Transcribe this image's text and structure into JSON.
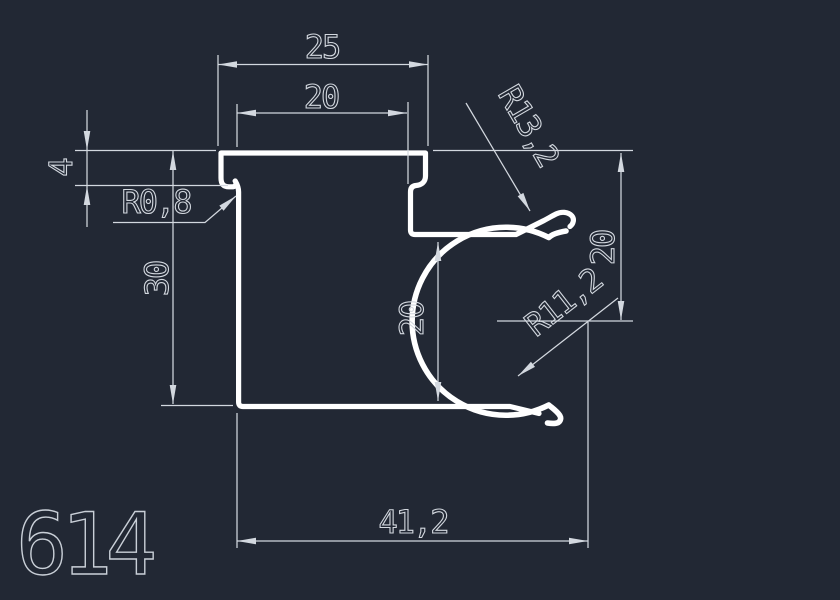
{
  "canvas": {
    "background": "#222834",
    "profile_stroke": "#ffffff",
    "dim_stroke": "#d3d8df",
    "label_color": "#c9cfd7"
  },
  "part": {
    "number": "614"
  },
  "dimensions": {
    "top_width": "25",
    "top_inner_width": "20",
    "lip_height": "4",
    "left_height": "30",
    "mid_depth": "20",
    "right_depth": "20",
    "bottom_width": "41,2",
    "lip_radius": "R0,8",
    "hook_radius": "R13,2",
    "channel_radius": "R11,2"
  }
}
